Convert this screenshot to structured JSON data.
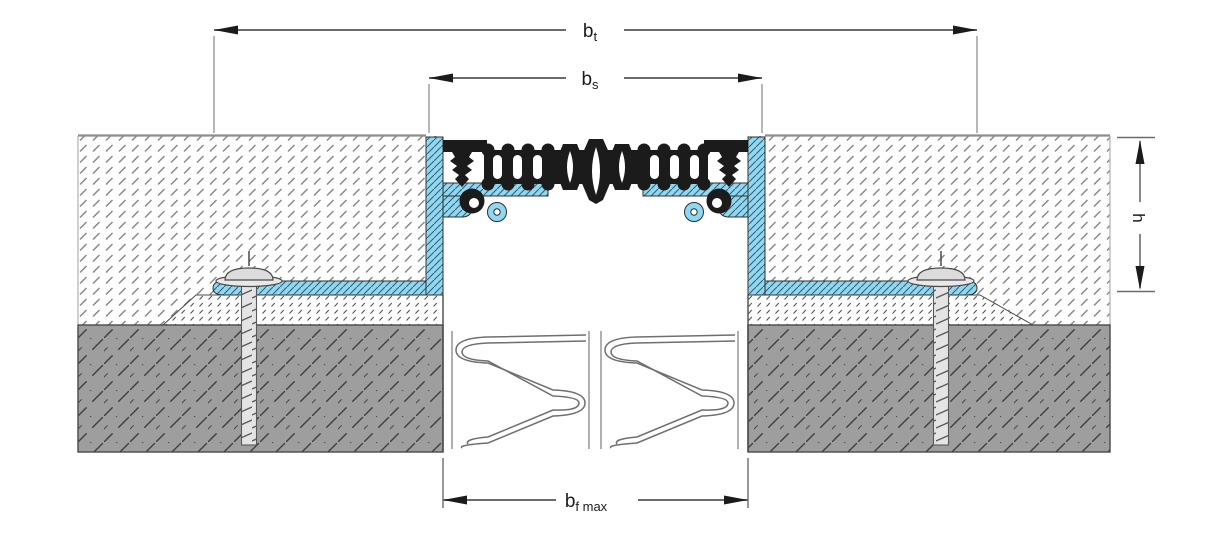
{
  "dimensions": {
    "bt": {
      "base": "b",
      "sub": "t"
    },
    "bs": {
      "base": "b",
      "sub": "s"
    },
    "h": {
      "label": "h"
    },
    "bf_max": {
      "base": "b",
      "sub": "f max"
    }
  },
  "colors": {
    "aluminium_profile_blue": "#8FD8F3",
    "aluminium_hatch": "#3B5F6E",
    "concrete_gray": "#9E9E9E",
    "concrete_hatch": "#3F3F3F",
    "screed_hatch": "#8A8A8A",
    "mortar_hatch": "#555555",
    "rubber_black": "#1B1B1B",
    "screw_metal": "#E4E4E4",
    "dimension_line": "#6B6B6B",
    "extension_line": "#9A9A9A",
    "surface_line": "#8D8D8D",
    "outline": "#4A4A4A",
    "background": "#FFFFFF"
  }
}
